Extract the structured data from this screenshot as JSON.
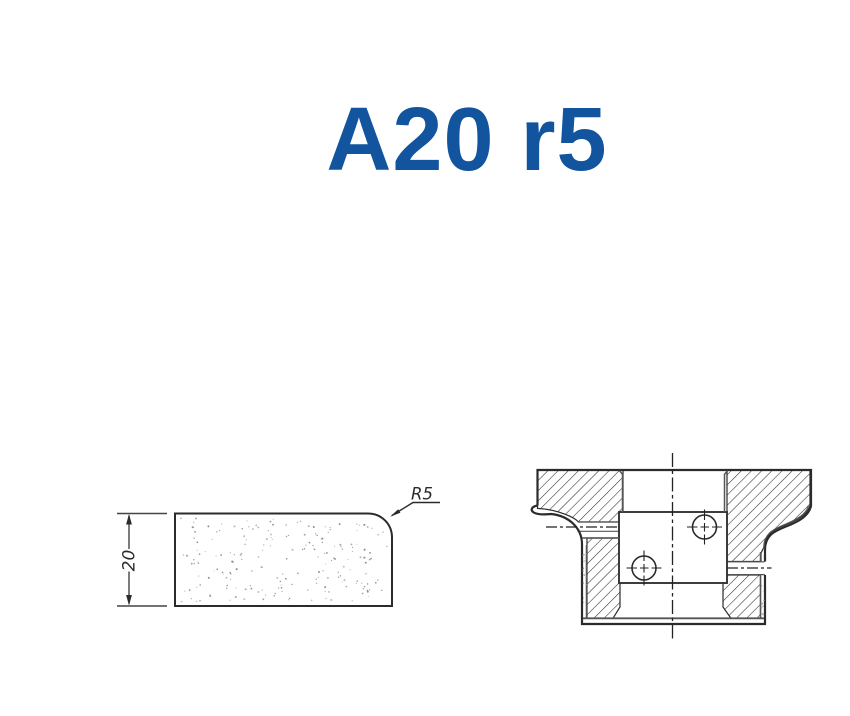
{
  "title": {
    "text": "A20 r5",
    "color": "#12549e"
  },
  "profile_view": {
    "dimension_label": "20",
    "radius_label": "R5"
  },
  "section_view": {
    "hatch_style": "diagonal-45",
    "hole_count": 2
  },
  "colors": {
    "line": "#2b2b2b",
    "thin_line": "#555555",
    "stipple": [
      "#8f8f8f",
      "#a6a6a6",
      "#bdbdbd"
    ]
  }
}
